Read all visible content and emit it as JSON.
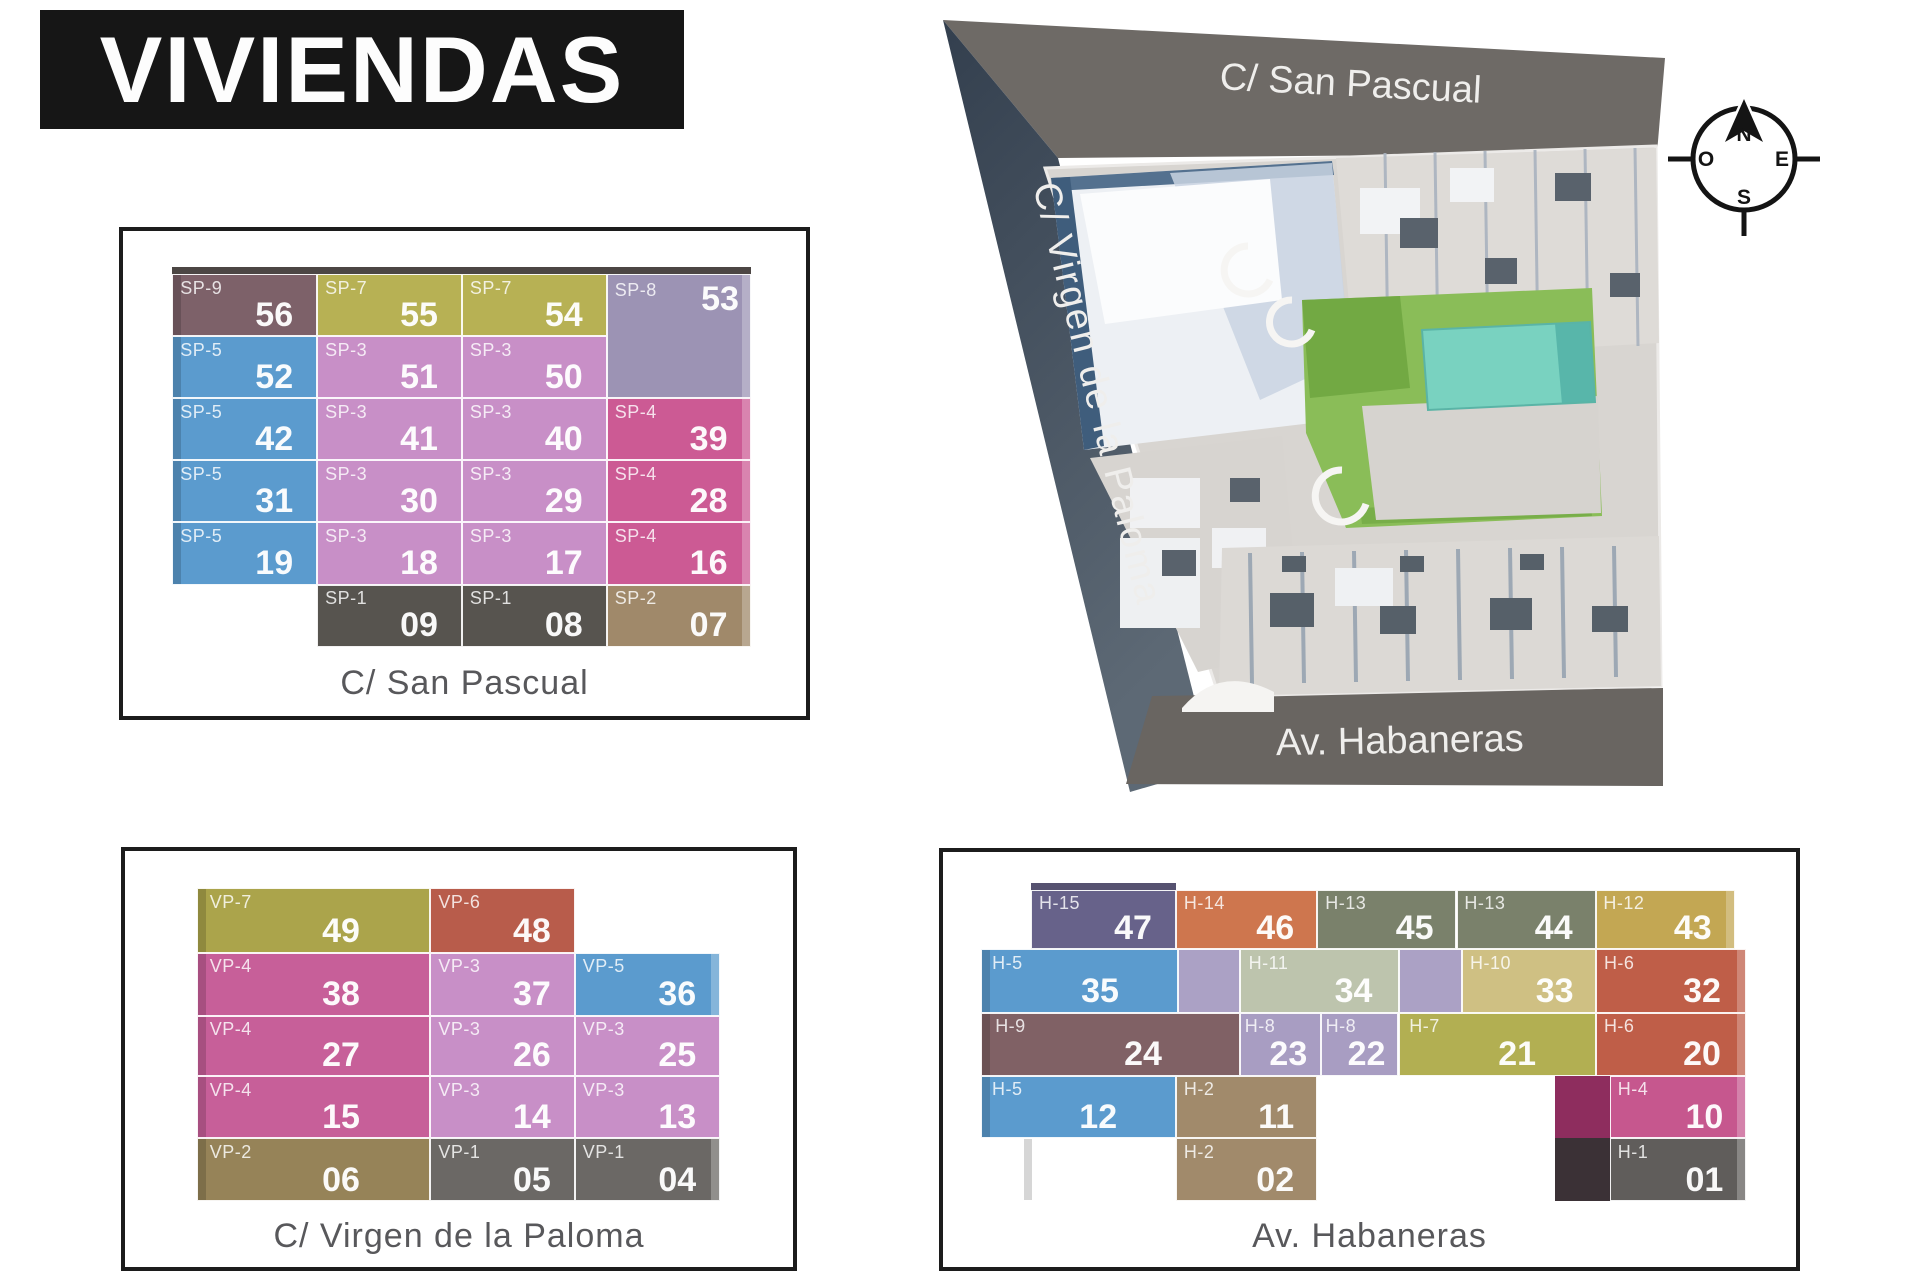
{
  "title": "VIVIENDAS",
  "aerial": {
    "street_top": "C/ San Pascual",
    "street_left": "C/ Virgen de la Paloma",
    "street_bottom": "Av. Habaneras",
    "compass": {
      "n": "N",
      "s": "S",
      "e": "E",
      "o": "O"
    }
  },
  "colors": {
    "plum": "#7d6169",
    "olive": "#b7b154",
    "lavgray": "#9c93b4",
    "blue": "#5b9bce",
    "orchid": "#c88fc7",
    "raspberry": "#cc5a94",
    "dgray1": "#57544f",
    "tan": "#a0896a",
    "edgeDark": "#4c4644",
    "olive2": "#aba44b",
    "terracotta": "#b85c4b",
    "magenta": "#c75f99",
    "khaki": "#968358",
    "dgray2": "#6b6865",
    "slate": "#67628a",
    "orange": "#ce764e",
    "graygreen": "#7a816b",
    "gold": "#c3a753",
    "lavlight": "#aba1c5",
    "sage": "#bdc4ad",
    "palegold": "#cfc083",
    "terracotta2": "#bf5e48",
    "mauvebrown": "#806165",
    "lavender": "#a89dc2",
    "olive3": "#b2af52",
    "tan2": "#a18a6b",
    "dmag": "#8e2d5e",
    "pink": "#c6578e",
    "neardark": "#3b3136",
    "gray2": "#605d5b",
    "edgeSlate": "#565270"
  },
  "panels": [
    {
      "street": "C/ San Pascual",
      "cells": [
        {
          "x": 7.2,
          "y": 7.4,
          "w": 84.8,
          "h": 1.7,
          "c": "edgeDark",
          "flat": 1
        },
        {
          "l": "SP-9",
          "n": "56",
          "x": 7.2,
          "y": 8.9,
          "w": 21.2,
          "h": 12.8,
          "c": "plum",
          "el": 1
        },
        {
          "l": "SP-7",
          "n": "55",
          "x": 28.4,
          "y": 8.9,
          "w": 21.2,
          "h": 12.8,
          "c": "olive"
        },
        {
          "l": "SP-7",
          "n": "54",
          "x": 49.6,
          "y": 8.9,
          "w": 21.2,
          "h": 12.8,
          "c": "olive"
        },
        {
          "l": "SP-8",
          "n": "53",
          "x": 70.8,
          "y": 8.9,
          "w": 21.2,
          "h": 25.6,
          "c": "lavgray",
          "numtop": 1,
          "er": 1
        },
        {
          "l": "SP-5",
          "n": "52",
          "x": 7.2,
          "y": 21.7,
          "w": 21.2,
          "h": 12.8,
          "c": "blue",
          "el": 1
        },
        {
          "l": "SP-3",
          "n": "51",
          "x": 28.4,
          "y": 21.7,
          "w": 21.2,
          "h": 12.8,
          "c": "orchid"
        },
        {
          "l": "SP-3",
          "n": "50",
          "x": 49.6,
          "y": 21.7,
          "w": 21.2,
          "h": 12.8,
          "c": "orchid"
        },
        {
          "l": "SP-5",
          "n": "42",
          "x": 7.2,
          "y": 34.5,
          "w": 21.2,
          "h": 12.8,
          "c": "blue",
          "el": 1
        },
        {
          "l": "SP-3",
          "n": "41",
          "x": 28.4,
          "y": 34.5,
          "w": 21.2,
          "h": 12.8,
          "c": "orchid"
        },
        {
          "l": "SP-3",
          "n": "40",
          "x": 49.6,
          "y": 34.5,
          "w": 21.2,
          "h": 12.8,
          "c": "orchid"
        },
        {
          "l": "SP-4",
          "n": "39",
          "x": 70.8,
          "y": 34.5,
          "w": 21.2,
          "h": 12.8,
          "c": "raspberry",
          "er": 1
        },
        {
          "l": "SP-5",
          "n": "31",
          "x": 7.2,
          "y": 47.3,
          "w": 21.2,
          "h": 12.8,
          "c": "blue",
          "el": 1
        },
        {
          "l": "SP-3",
          "n": "30",
          "x": 28.4,
          "y": 47.3,
          "w": 21.2,
          "h": 12.8,
          "c": "orchid"
        },
        {
          "l": "SP-3",
          "n": "29",
          "x": 49.6,
          "y": 47.3,
          "w": 21.2,
          "h": 12.8,
          "c": "orchid"
        },
        {
          "l": "SP-4",
          "n": "28",
          "x": 70.8,
          "y": 47.3,
          "w": 21.2,
          "h": 12.8,
          "c": "raspberry",
          "er": 1
        },
        {
          "l": "SP-5",
          "n": "19",
          "x": 7.2,
          "y": 60.1,
          "w": 21.2,
          "h": 12.8,
          "c": "blue",
          "el": 1
        },
        {
          "l": "SP-3",
          "n": "18",
          "x": 28.4,
          "y": 60.1,
          "w": 21.2,
          "h": 12.8,
          "c": "orchid"
        },
        {
          "l": "SP-3",
          "n": "17",
          "x": 49.6,
          "y": 60.1,
          "w": 21.2,
          "h": 12.8,
          "c": "orchid"
        },
        {
          "l": "SP-4",
          "n": "16",
          "x": 70.8,
          "y": 60.1,
          "w": 21.2,
          "h": 12.8,
          "c": "raspberry",
          "er": 1
        },
        {
          "l": "SP-1",
          "n": "09",
          "x": 28.4,
          "y": 72.9,
          "w": 21.2,
          "h": 12.8,
          "c": "dgray1"
        },
        {
          "l": "SP-1",
          "n": "08",
          "x": 49.6,
          "y": 72.9,
          "w": 21.2,
          "h": 12.8,
          "c": "dgray1"
        },
        {
          "l": "SP-2",
          "n": "07",
          "x": 70.8,
          "y": 72.9,
          "w": 21.2,
          "h": 12.8,
          "c": "tan",
          "er": 1
        }
      ]
    },
    {
      "street": "C/ Virgen de la Paloma",
      "cells": [
        {
          "l": "VP-7",
          "n": "49",
          "x": 10.8,
          "y": 9.0,
          "w": 34.9,
          "h": 15.5,
          "c": "olive2",
          "wide": 1,
          "el": 1
        },
        {
          "l": "VP-6",
          "n": "48",
          "x": 45.7,
          "y": 9.0,
          "w": 21.6,
          "h": 15.5,
          "c": "terracotta"
        },
        {
          "l": "VP-4",
          "n": "38",
          "x": 10.8,
          "y": 24.5,
          "w": 34.9,
          "h": 15.1,
          "c": "magenta",
          "wide": 1,
          "el": 1
        },
        {
          "l": "VP-3",
          "n": "37",
          "x": 45.7,
          "y": 24.5,
          "w": 21.6,
          "h": 15.1,
          "c": "orchid"
        },
        {
          "l": "VP-5",
          "n": "36",
          "x": 67.3,
          "y": 24.5,
          "w": 21.8,
          "h": 15.1,
          "c": "blue",
          "er": 1
        },
        {
          "l": "VP-4",
          "n": "27",
          "x": 10.8,
          "y": 39.6,
          "w": 34.9,
          "h": 14.6,
          "c": "magenta",
          "wide": 1,
          "el": 1
        },
        {
          "l": "VP-3",
          "n": "26",
          "x": 45.7,
          "y": 39.6,
          "w": 21.6,
          "h": 14.6,
          "c": "orchid"
        },
        {
          "l": "VP-3",
          "n": "25",
          "x": 67.3,
          "y": 39.6,
          "w": 21.8,
          "h": 14.6,
          "c": "orchid"
        },
        {
          "l": "VP-4",
          "n": "15",
          "x": 10.8,
          "y": 54.2,
          "w": 34.9,
          "h": 14.9,
          "c": "magenta",
          "wide": 1,
          "el": 1
        },
        {
          "l": "VP-3",
          "n": "14",
          "x": 45.7,
          "y": 54.2,
          "w": 21.6,
          "h": 14.9,
          "c": "orchid"
        },
        {
          "l": "VP-3",
          "n": "13",
          "x": 67.3,
          "y": 54.2,
          "w": 21.8,
          "h": 14.9,
          "c": "orchid"
        },
        {
          "l": "VP-2",
          "n": "06",
          "x": 10.8,
          "y": 69.1,
          "w": 34.9,
          "h": 15.1,
          "c": "khaki",
          "wide": 1,
          "el": 1
        },
        {
          "l": "VP-1",
          "n": "05",
          "x": 45.7,
          "y": 69.1,
          "w": 21.6,
          "h": 15.1,
          "c": "dgray2"
        },
        {
          "l": "VP-1",
          "n": "04",
          "x": 67.3,
          "y": 69.1,
          "w": 21.8,
          "h": 15.1,
          "c": "dgray2",
          "er": 1
        }
      ]
    },
    {
      "street": "Av. Habaneras",
      "cells": [
        {
          "x": 10.3,
          "y": 7.5,
          "w": 17.0,
          "h": 1.9,
          "c": "edgeSlate",
          "flat": 1
        },
        {
          "l": "H-15",
          "n": "47",
          "x": 10.3,
          "y": 9.2,
          "w": 17.0,
          "h": 14.2,
          "c": "slate"
        },
        {
          "l": "H-14",
          "n": "46",
          "x": 27.3,
          "y": 9.2,
          "w": 16.6,
          "h": 14.2,
          "c": "orange"
        },
        {
          "l": "H-13",
          "n": "45",
          "x": 43.9,
          "y": 9.2,
          "w": 16.3,
          "h": 14.2,
          "c": "graygreen"
        },
        {
          "l": "H-13",
          "n": "44",
          "x": 60.2,
          "y": 9.2,
          "w": 16.3,
          "h": 14.2,
          "c": "graygreen"
        },
        {
          "l": "H-12",
          "n": "43",
          "x": 76.5,
          "y": 9.2,
          "w": 16.3,
          "h": 14.2,
          "c": "gold",
          "er": 1
        },
        {
          "l": "H-5",
          "n": "35",
          "x": 4.5,
          "y": 23.4,
          "w": 23.1,
          "h": 15.4,
          "c": "blue",
          "wide": 1,
          "el": 1
        },
        {
          "x": 27.6,
          "y": 23.4,
          "w": 7.2,
          "h": 15.4,
          "c": "lavlight"
        },
        {
          "l": "H-11",
          "n": "34",
          "x": 34.8,
          "y": 23.4,
          "w": 18.6,
          "h": 15.4,
          "c": "sage"
        },
        {
          "x": 53.4,
          "y": 23.4,
          "w": 7.5,
          "h": 15.4,
          "c": "lavlight"
        },
        {
          "l": "H-10",
          "n": "33",
          "x": 60.9,
          "y": 23.4,
          "w": 15.6,
          "h": 15.4,
          "c": "palegold"
        },
        {
          "l": "H-6",
          "n": "32",
          "x": 76.5,
          "y": 23.4,
          "w": 17.6,
          "h": 15.4,
          "c": "terracotta2",
          "er": 1
        },
        {
          "l": "H-9",
          "n": "24",
          "x": 4.5,
          "y": 38.8,
          "w": 30.3,
          "h": 15.1,
          "c": "mauvebrown",
          "wide": 1,
          "el": 1
        },
        {
          "l": "H-8",
          "n": "23",
          "x": 34.8,
          "y": 38.8,
          "w": 9.5,
          "h": 15.1,
          "c": "lavender"
        },
        {
          "l": "H-8",
          "n": "22",
          "x": 44.3,
          "y": 38.8,
          "w": 9.1,
          "h": 15.1,
          "c": "lavender"
        },
        {
          "l": "H-7",
          "n": "21",
          "x": 53.4,
          "y": 38.8,
          "w": 23.1,
          "h": 15.1,
          "c": "olive3",
          "wide": 1
        },
        {
          "l": "H-6",
          "n": "20",
          "x": 76.5,
          "y": 38.8,
          "w": 17.6,
          "h": 15.1,
          "c": "terracotta2",
          "er": 1
        },
        {
          "l": "H-5",
          "n": "12",
          "x": 4.5,
          "y": 53.9,
          "w": 22.8,
          "h": 15.1,
          "c": "blue",
          "wide": 1,
          "el": 1
        },
        {
          "l": "H-2",
          "n": "11",
          "x": 27.3,
          "y": 53.9,
          "w": 16.6,
          "h": 15.1,
          "c": "tan2"
        },
        {
          "x": 71.7,
          "y": 53.9,
          "w": 6.5,
          "h": 15.1,
          "c": "dmag",
          "flat": 1
        },
        {
          "l": "H-4",
          "n": "10",
          "x": 78.2,
          "y": 53.9,
          "w": 15.9,
          "h": 15.1,
          "c": "pink",
          "er": 1
        },
        {
          "l": "H-3",
          "n": "03",
          "x": 9.4,
          "y": 69.0,
          "w": 17.9,
          "h": 15.2,
          "c": "orchid2",
          "el": 1
        },
        {
          "l": "H-2",
          "n": "02",
          "x": 27.3,
          "y": 69.0,
          "w": 16.6,
          "h": 15.2,
          "c": "tan2"
        },
        {
          "x": 71.7,
          "y": 69.0,
          "w": 6.5,
          "h": 15.2,
          "c": "neardark",
          "flat": 1
        },
        {
          "l": "H-1",
          "n": "01",
          "x": 78.2,
          "y": 69.0,
          "w": 15.9,
          "h": 15.2,
          "c": "gray2",
          "er": 1
        }
      ]
    }
  ]
}
